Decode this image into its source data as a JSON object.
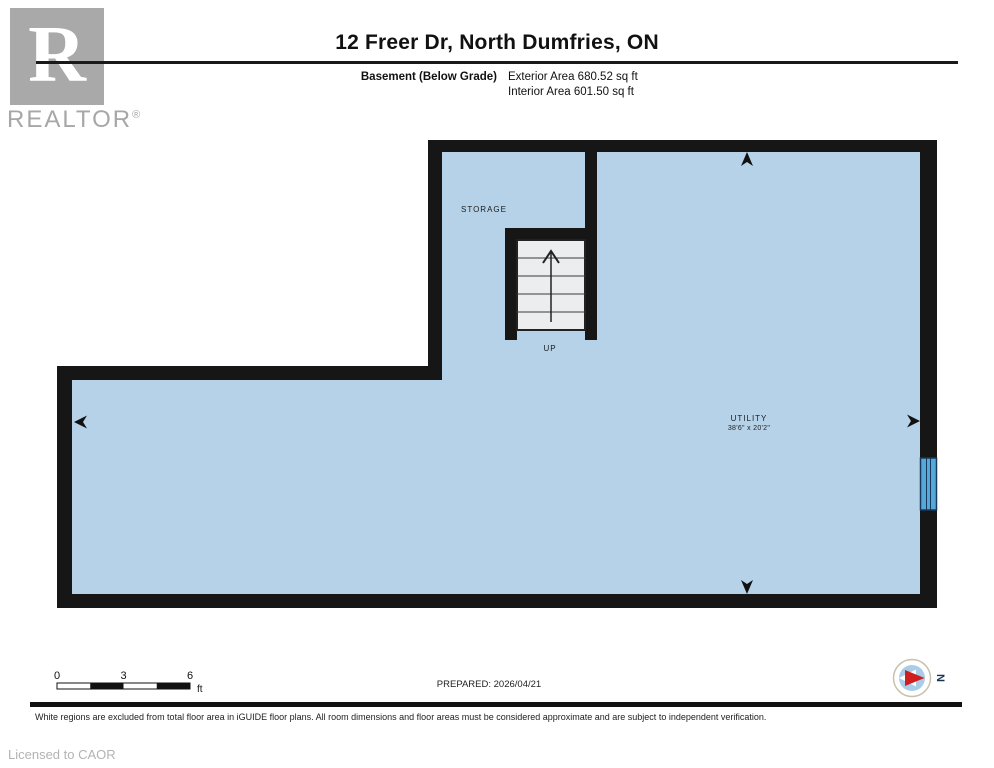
{
  "header": {
    "logo": {
      "letter": "R",
      "brand": "REALTOR",
      "registered": "®"
    },
    "title": "12 Freer Dr, North Dumfries, ON",
    "floor_label": "Basement (Below Grade)",
    "exterior_area": "Exterior Area 680.52 sq ft",
    "interior_area": "Interior Area 601.50 sq ft"
  },
  "plan": {
    "labels": {
      "storage": "STORAGE",
      "up": "UP",
      "utility": "UTILITY",
      "utility_dimensions": "38'6\" x 20'2\""
    },
    "colors": {
      "floor": "#b6d2e8",
      "wall": "#161616",
      "stair_fill": "#ebedee",
      "window": "#55a9da",
      "window_frame": "#17395a",
      "compass_red": "#cf1f1f",
      "compass_blue": "#a9cde9",
      "brand_gray": "#a7a7a7"
    }
  },
  "footer": {
    "scale": {
      "ticks": [
        "0",
        "3",
        "6"
      ],
      "unit": "ft"
    },
    "prepared": "PREPARED: 2026/04/21",
    "compass_label": "N",
    "disclaimer": "White regions are excluded from total floor area in iGUIDE floor plans. All room dimensions and floor areas must be considered approximate and are subject to independent verification.",
    "license": "Licensed to CAOR"
  }
}
